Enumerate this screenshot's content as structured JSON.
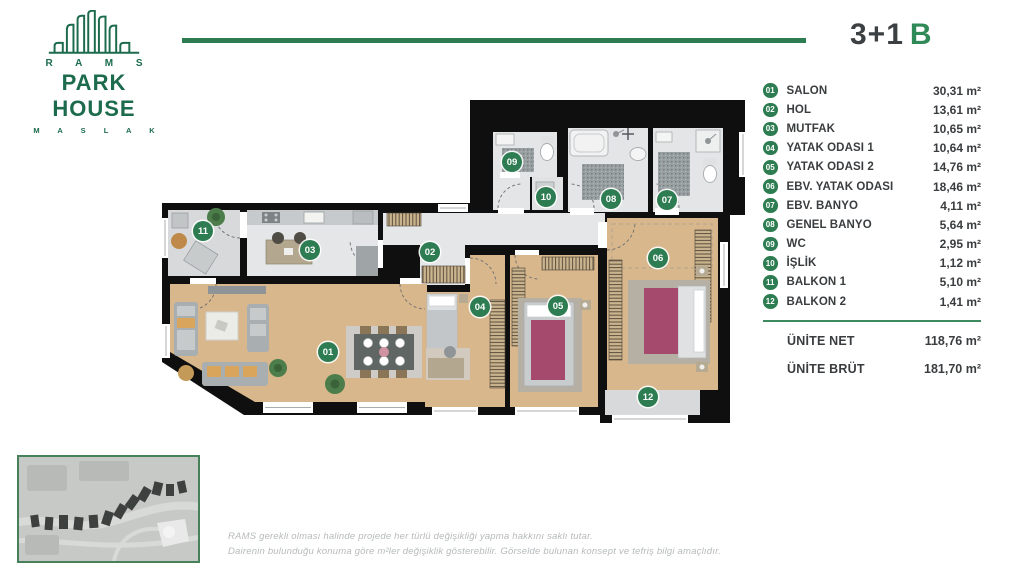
{
  "logo": {
    "brand": "R A M S",
    "name": "PARK HOUSE",
    "location": "M A S L A K"
  },
  "header": {
    "title": "3+1",
    "variant": "B"
  },
  "legend": {
    "rooms": [
      {
        "num": "01",
        "label": "SALON",
        "area": "30,31 m²"
      },
      {
        "num": "02",
        "label": "HOL",
        "area": "13,61 m²"
      },
      {
        "num": "03",
        "label": "MUTFAK",
        "area": "10,65 m²"
      },
      {
        "num": "04",
        "label": "YATAK ODASI 1",
        "area": "10,64 m²"
      },
      {
        "num": "05",
        "label": "YATAK ODASI 2",
        "area": "14,76 m²"
      },
      {
        "num": "06",
        "label": "EBV. YATAK ODASI",
        "area": "18,46 m²"
      },
      {
        "num": "07",
        "label": "EBV. BANYO",
        "area": "4,11 m²"
      },
      {
        "num": "08",
        "label": "GENEL BANYO",
        "area": "5,64 m²"
      },
      {
        "num": "09",
        "label": "WC",
        "area": "2,95 m²"
      },
      {
        "num": "10",
        "label": "İŞLİK",
        "area": "1,12 m²"
      },
      {
        "num": "11",
        "label": "BALKON 1",
        "area": "5,10 m²"
      },
      {
        "num": "12",
        "label": "BALKON 2",
        "area": "1,41 m²"
      }
    ],
    "totals": [
      {
        "label": "ÜNİTE NET",
        "area": "118,76 m²"
      },
      {
        "label": "ÜNİTE BRÜT",
        "area": "181,70 m²"
      }
    ]
  },
  "footer": {
    "line1": "RAMS gerekli olması halinde projede her türlü değişikliği yapma hakkını saklı tutar.",
    "line2": "Dairenin bulunduğu konuma göre m²ler değişiklik gösterebilir. Görselde bulunan konsept ve tefriş bilgi amaçlıdır."
  },
  "colors": {
    "brand_green": "#1c6b4d",
    "accent_green": "#2e7d52",
    "wall": "#0f0f0f",
    "wood": "#d9b78c"
  }
}
